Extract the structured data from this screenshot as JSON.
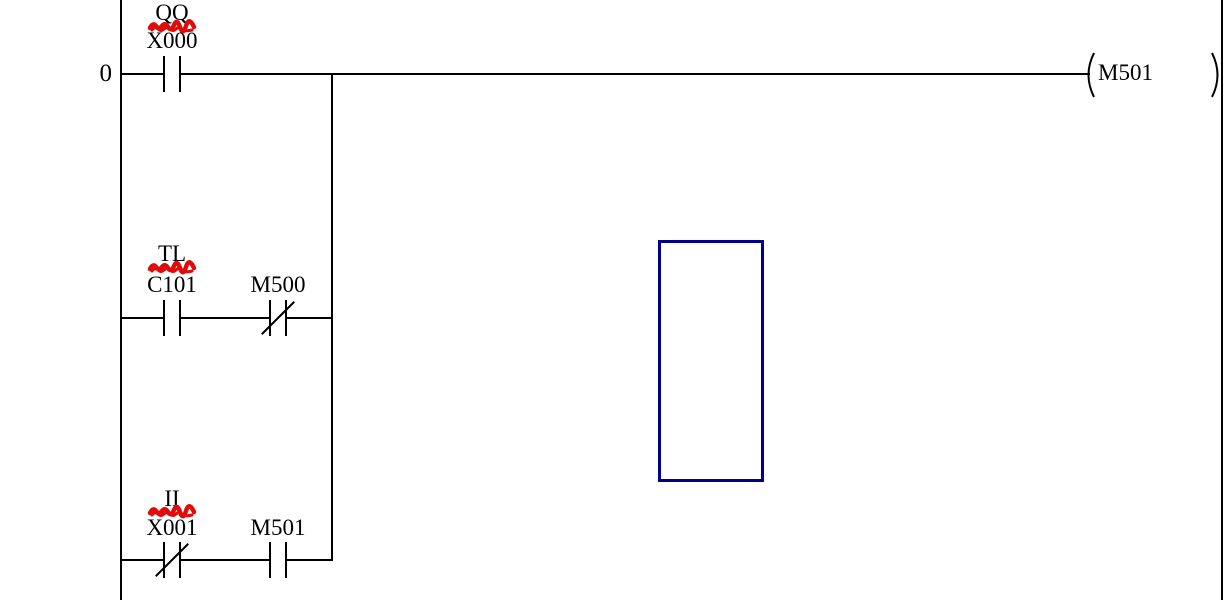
{
  "rung": {
    "number": "0"
  },
  "contacts": {
    "x000": {
      "comment": "QQ",
      "address": "X000",
      "type": "normally-open"
    },
    "c101": {
      "comment": "TL",
      "address": "C101",
      "type": "normally-open"
    },
    "m500": {
      "address": "M500",
      "type": "normally-closed"
    },
    "x001": {
      "comment": "II",
      "address": "X001",
      "type": "normally-closed"
    },
    "m501": {
      "address": "M501",
      "type": "normally-open"
    }
  },
  "coil": {
    "address": "M501"
  },
  "colors": {
    "wire": "#000000",
    "text": "#000000",
    "scribble": "#e00b0b",
    "cursor_border": "#00008b",
    "background": "#ffffff"
  }
}
